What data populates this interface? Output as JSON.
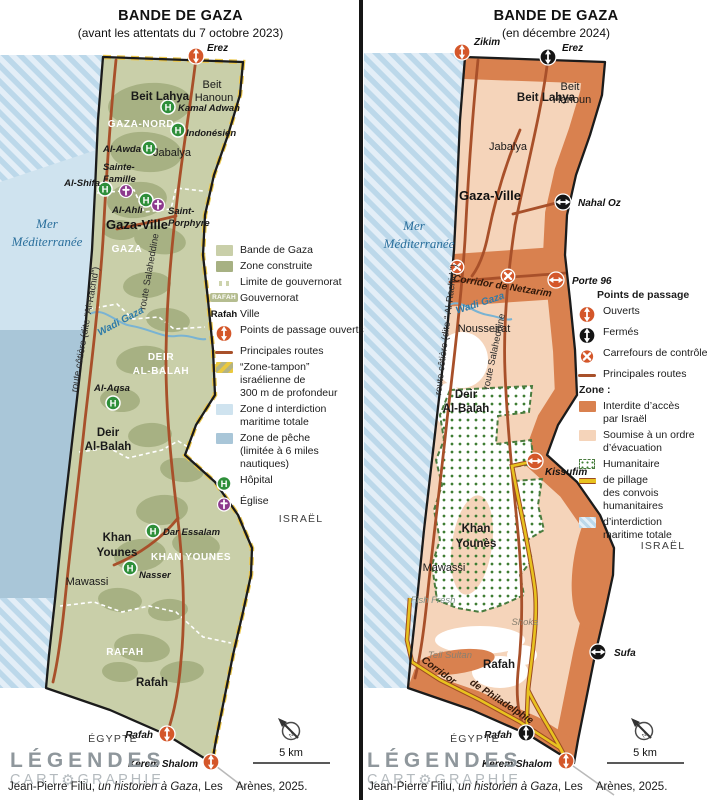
{
  "colors": {
    "land_green": "#c9cfa9",
    "built": "#a7b183",
    "buffer": "#ecc84d",
    "sea_light": "#cfe3ef",
    "fish": "#a9c6d8",
    "hatch_a": "#bcd8ea",
    "hatch_b": "#e3eef7",
    "road": "#a8502a",
    "open": "#d4572a",
    "closed": "#151515",
    "hospital": "#2e8f3a",
    "church": "#8d3a8d",
    "land_peach": "#f5d4ba",
    "forbidden": "#d9814f",
    "hum_dot": "#3e7d33",
    "hum_border": "#4a7c3f",
    "pillage": "#e8c21f",
    "pillage_edge": "#9c4b21",
    "divider": "#161616"
  },
  "logo": {
    "line1": "LÉGENDES",
    "cart_pre": "CART",
    "gear": "⚙",
    "cart_post": "GRAPHIE"
  },
  "credit": {
    "pre": "Jean-Pierre Filiu, ",
    "title": "un historien à Gaza",
    "post": ", Les",
    "post2": "Arènes, 2025."
  },
  "panels": [
    {
      "key": "left",
      "title": "BANDE DE GAZA",
      "subtitle": "(avant les attentats du 7 octobre 2023)",
      "labels": [
        {
          "t": "Beit Lahya",
          "x": 160,
          "y": 100,
          "c": "city-bold"
        },
        {
          "t": "Beit",
          "x": 212,
          "y": 88,
          "c": "city"
        },
        {
          "t": "Hanoun",
          "x": 214,
          "y": 101,
          "c": "city"
        },
        {
          "t": "Jabalya",
          "x": 172,
          "y": 156,
          "c": "city"
        },
        {
          "t": "Gaza-Ville",
          "x": 137,
          "y": 229,
          "c": "city-big"
        },
        {
          "t": "Deir",
          "x": 108,
          "y": 436,
          "c": "city-bold"
        },
        {
          "t": "Al-Balah",
          "x": 108,
          "y": 450,
          "c": "city-bold"
        },
        {
          "t": "Khan",
          "x": 117,
          "y": 541,
          "c": "city-bold"
        },
        {
          "t": "Younes",
          "x": 117,
          "y": 556,
          "c": "city-bold"
        },
        {
          "t": "Mawassi",
          "x": 87,
          "y": 585,
          "c": "city"
        },
        {
          "t": "Rafah",
          "x": 152,
          "y": 686,
          "c": "city-bold"
        },
        {
          "t": "GAZA-NORD",
          "x": 141,
          "y": 127,
          "c": "gov"
        },
        {
          "t": "GAZA",
          "x": 127,
          "y": 252,
          "c": "gov"
        },
        {
          "t": "DEIR",
          "x": 161,
          "y": 360,
          "c": "gov"
        },
        {
          "t": "AL-BALAH",
          "x": 161,
          "y": 374,
          "c": "gov"
        },
        {
          "t": "KHAN YOUNES",
          "x": 191,
          "y": 560,
          "c": "gov"
        },
        {
          "t": "RAFAH",
          "x": 125,
          "y": 655,
          "c": "gov"
        },
        {
          "t": "Kamal Adwan",
          "x": 178,
          "y": 111,
          "c": "poi",
          "a": "s"
        },
        {
          "t": "Indonésien",
          "x": 186,
          "y": 136,
          "c": "poi",
          "a": "s"
        },
        {
          "t": "Al-Awda",
          "x": 141,
          "y": 152,
          "c": "poi",
          "a": "e"
        },
        {
          "t": "Al-Shifa",
          "x": 100,
          "y": 186,
          "c": "poi",
          "a": "e"
        },
        {
          "t": "Al-Ahli",
          "x": 112,
          "y": 213,
          "c": "poi",
          "a": "s"
        },
        {
          "t": "Sainte-",
          "x": 103,
          "y": 170,
          "c": "poi",
          "a": "s"
        },
        {
          "t": "Famille",
          "x": 103,
          "y": 182,
          "c": "poi",
          "a": "s"
        },
        {
          "t": "Saint-",
          "x": 168,
          "y": 214,
          "c": "poi",
          "a": "s"
        },
        {
          "t": "Porphyre",
          "x": 168,
          "y": 226,
          "c": "poi",
          "a": "s"
        },
        {
          "t": "Al-Aqsa",
          "x": 112,
          "y": 391,
          "c": "poi"
        },
        {
          "t": "Dar Essalam",
          "x": 163,
          "y": 535,
          "c": "poi",
          "a": "s"
        },
        {
          "t": "Nasser",
          "x": 139,
          "y": 578,
          "c": "poi",
          "a": "s"
        },
        {
          "t": "Erez",
          "x": 207,
          "y": 51,
          "c": "cross",
          "a": "s"
        },
        {
          "t": "Rafah",
          "x": 153,
          "y": 738,
          "c": "cross",
          "a": "e"
        },
        {
          "t": "Kerem Shalom",
          "x": 198,
          "y": 767,
          "c": "cross",
          "a": "e"
        },
        {
          "t": "route côtière (dite “Al-Rachid”)",
          "x": 88,
          "y": 330,
          "c": "route",
          "r": -80
        },
        {
          "t": "route Salaheddine",
          "x": 152,
          "y": 272,
          "c": "route",
          "r": -80
        },
        {
          "t": "Wadi Gaza",
          "x": 122,
          "y": 324,
          "c": "water",
          "r": -28
        },
        {
          "t": "Mer",
          "x": 47,
          "y": 228,
          "c": "sea"
        },
        {
          "t": "Méditerranée",
          "x": 47,
          "y": 246,
          "c": "sea"
        },
        {
          "t": "ISRAËL",
          "x": 301,
          "y": 522,
          "c": "region"
        },
        {
          "t": "ÉGYPTE",
          "x": 113,
          "y": 742,
          "c": "region"
        },
        {
          "t": "5 km",
          "x": 291,
          "y": 756,
          "c": "scalelbl"
        }
      ],
      "markers": [
        {
          "k": "open",
          "x": 196,
          "y": 56,
          "o": "v"
        },
        {
          "k": "open",
          "x": 167,
          "y": 734,
          "o": "v"
        },
        {
          "k": "open",
          "x": 211,
          "y": 762,
          "o": "v"
        },
        {
          "k": "hosp",
          "x": 168,
          "y": 107
        },
        {
          "k": "hosp",
          "x": 178,
          "y": 130
        },
        {
          "k": "hosp",
          "x": 149,
          "y": 148
        },
        {
          "k": "hosp",
          "x": 105,
          "y": 189
        },
        {
          "k": "hosp",
          "x": 146,
          "y": 200
        },
        {
          "k": "hosp",
          "x": 113,
          "y": 403
        },
        {
          "k": "hosp",
          "x": 153,
          "y": 531
        },
        {
          "k": "hosp",
          "x": 130,
          "y": 568
        },
        {
          "k": "church",
          "x": 126,
          "y": 191
        },
        {
          "k": "church",
          "x": 158,
          "y": 205
        }
      ],
      "legend": {
        "x": 214,
        "y": 244,
        "items": [
          {
            "type": "swatch",
            "color": "#c9cfa9",
            "label": "Bande de Gaza"
          },
          {
            "type": "swatch",
            "color": "#a7b183",
            "label": "Zone construite"
          },
          {
            "type": "gov-limit",
            "label": "Limite de gouvernorat"
          },
          {
            "type": "chip",
            "key_text": "RAFAH",
            "label": "Gouvernorat"
          },
          {
            "type": "text-key",
            "key_text": "Rafah",
            "label": "Ville"
          },
          {
            "type": "icon-open",
            "label": "Points de passage ouverts"
          },
          {
            "type": "road",
            "label": "Principales routes"
          },
          {
            "type": "buffer",
            "label": "“Zone-tampon”\nisraélienne de\n300 m de profondeur"
          },
          {
            "type": "swatch",
            "color": "#cfe3ef",
            "label": "Zone d interdiction\nmaritime totale"
          },
          {
            "type": "swatch",
            "color": "#a9c6d8",
            "label": "Zone de pêche\n(limitée à 6 miles\nnautiques)"
          },
          {
            "type": "icon-hosp",
            "label": "Hôpital"
          },
          {
            "type": "icon-church",
            "label": "Église"
          }
        ]
      }
    },
    {
      "key": "right",
      "title": "BANDE DE GAZA",
      "subtitle": "(en décembre 2024)",
      "labels": [
        {
          "t": "Zikim",
          "x": 474,
          "y": 45,
          "c": "cross",
          "a": "s"
        },
        {
          "t": "Erez",
          "x": 562,
          "y": 51,
          "c": "cross",
          "a": "s"
        },
        {
          "t": "Beit Lahya",
          "x": 546,
          "y": 101,
          "c": "city-bold"
        },
        {
          "t": "Beit",
          "x": 570,
          "y": 90,
          "c": "city"
        },
        {
          "t": "Hanoun",
          "x": 572,
          "y": 103,
          "c": "city"
        },
        {
          "t": "Jabalya",
          "x": 508,
          "y": 150,
          "c": "city"
        },
        {
          "t": "Gaza-Ville",
          "x": 490,
          "y": 200,
          "c": "city-big"
        },
        {
          "t": "Nahal Oz",
          "x": 578,
          "y": 206,
          "c": "cross",
          "a": "s"
        },
        {
          "t": "Corridor de Netzarim",
          "x": 502,
          "y": 289,
          "c": "corridor",
          "r": 9
        },
        {
          "t": "Porte 96",
          "x": 572,
          "y": 284,
          "c": "cross",
          "a": "s"
        },
        {
          "t": "Nousseirat",
          "x": 484,
          "y": 332,
          "c": "city"
        },
        {
          "t": "Deir",
          "x": 466,
          "y": 398,
          "c": "city-bold"
        },
        {
          "t": "Al-Balah",
          "x": 466,
          "y": 412,
          "c": "city-bold"
        },
        {
          "t": "Kissufim",
          "x": 545,
          "y": 475,
          "c": "cross",
          "a": "s"
        },
        {
          "t": "Khan",
          "x": 476,
          "y": 532,
          "c": "city-bold"
        },
        {
          "t": "Younès",
          "x": 476,
          "y": 547,
          "c": "city-bold"
        },
        {
          "t": "Mawassi",
          "x": 444,
          "y": 571,
          "c": "city"
        },
        {
          "t": "Fish Fresh",
          "x": 433,
          "y": 603,
          "c": "area-water"
        },
        {
          "t": "Shoka",
          "x": 525,
          "y": 625,
          "c": "area-it"
        },
        {
          "t": "Sufa",
          "x": 614,
          "y": 656,
          "c": "cross",
          "a": "s"
        },
        {
          "t": "Tell Sultan",
          "x": 450,
          "y": 658,
          "c": "area-it"
        },
        {
          "t": "Rafah",
          "x": 499,
          "y": 668,
          "c": "city-bold"
        },
        {
          "t": "Corridor",
          "x": 437,
          "y": 673,
          "c": "corridor",
          "r": 36
        },
        {
          "t": "de Philadelphie",
          "x": 500,
          "y": 704,
          "c": "corridor",
          "r": 33
        },
        {
          "t": "Rafah",
          "x": 512,
          "y": 738,
          "c": "cross",
          "a": "e"
        },
        {
          "t": "Kerem Shalom",
          "x": 552,
          "y": 767,
          "c": "cross",
          "a": "e"
        },
        {
          "t": "route côtière (dite “ Al-Rachid ”)",
          "x": 449,
          "y": 330,
          "c": "route",
          "r": -83
        },
        {
          "t": "route Salaheddine",
          "x": 497,
          "y": 352,
          "c": "route",
          "r": -78
        },
        {
          "t": "Wadi Gaza",
          "x": 481,
          "y": 306,
          "c": "water",
          "r": -18
        },
        {
          "t": "Mer",
          "x": 414,
          "y": 230,
          "c": "sea"
        },
        {
          "t": "Méditerranée",
          "x": 419,
          "y": 248,
          "c": "sea"
        },
        {
          "t": "ISRAËL",
          "x": 663,
          "y": 549,
          "c": "region"
        },
        {
          "t": "ÉGYPTE",
          "x": 475,
          "y": 742,
          "c": "region"
        },
        {
          "t": "5 km",
          "x": 645,
          "y": 756,
          "c": "scalelbl"
        }
      ],
      "markers": [
        {
          "k": "open",
          "x": 462,
          "y": 52,
          "o": "v"
        },
        {
          "k": "closed",
          "x": 548,
          "y": 57,
          "o": "v"
        },
        {
          "k": "closed",
          "x": 563,
          "y": 202,
          "o": "h"
        },
        {
          "k": "open",
          "x": 556,
          "y": 280,
          "o": "h"
        },
        {
          "k": "control",
          "x": 457,
          "y": 267
        },
        {
          "k": "control",
          "x": 508,
          "y": 276
        },
        {
          "k": "open",
          "x": 535,
          "y": 461,
          "o": "h"
        },
        {
          "k": "closed",
          "x": 598,
          "y": 652,
          "o": "h"
        },
        {
          "k": "closed",
          "x": 526,
          "y": 733,
          "o": "v"
        },
        {
          "k": "open",
          "x": 566,
          "y": 761,
          "o": "v"
        }
      ],
      "legend": {
        "x": 577,
        "y": 289,
        "items": [
          {
            "type": "header",
            "label": "Points de passage"
          },
          {
            "type": "icon-open",
            "label": "Ouverts"
          },
          {
            "type": "icon-closed",
            "label": "Fermés"
          },
          {
            "type": "icon-control",
            "label": "Carrefours de contrôle"
          },
          {
            "type": "road",
            "label": "Principales routes"
          },
          {
            "type": "header2",
            "label": "Zone :"
          },
          {
            "type": "swatch",
            "color": "#d9814f",
            "label": "Interdite d’accès\npar Israël"
          },
          {
            "type": "swatch",
            "color": "#f5d4ba",
            "label": "Soumise à un ordre\nd’évacuation"
          },
          {
            "type": "humanitarian",
            "label": "Humanitaire"
          },
          {
            "type": "pillage",
            "label": "de pillage\ndes convois\nhumanitaires"
          },
          {
            "type": "maritime-hatch",
            "label": "d’interdiction\nmaritime totale"
          }
        ]
      }
    }
  ]
}
